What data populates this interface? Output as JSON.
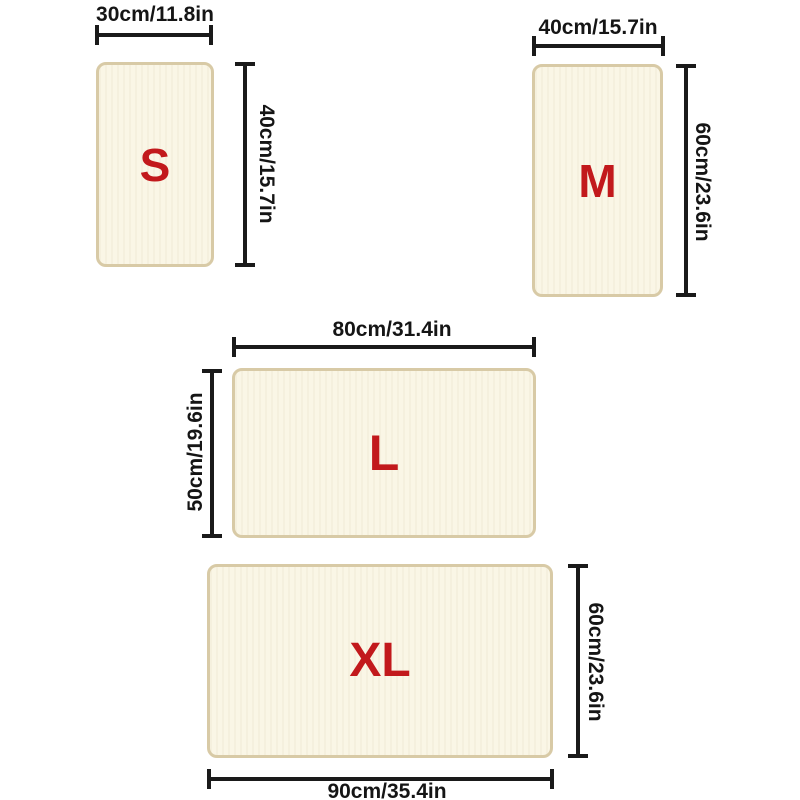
{
  "colors": {
    "background": "#ffffff",
    "mat_fill": "#faf6e6",
    "mat_border": "#d8caa6",
    "letter_red": "#c2191c",
    "dim_line": "#1a1a1a"
  },
  "sizes": [
    {
      "letter": "S",
      "width_label": "30cm/11.8in",
      "height_label": "40cm/15.7in"
    },
    {
      "letter": "M",
      "width_label": "40cm/15.7in",
      "height_label": "60cm/23.6in"
    },
    {
      "letter": "L",
      "width_label": "80cm/31.4in",
      "height_label": "50cm/19.6in"
    },
    {
      "letter": "XL",
      "width_label": "90cm/35.4in",
      "height_label": "60cm/23.6in"
    }
  ]
}
